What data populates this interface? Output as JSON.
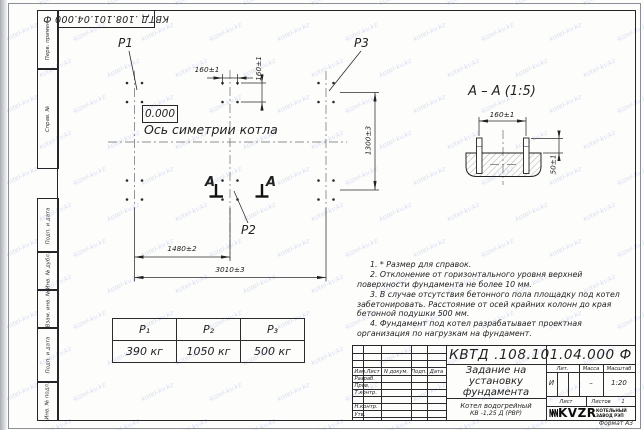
{
  "watermark": {
    "text": "kotel-kv.kz",
    "color": "#9fb0d8"
  },
  "top_stamp": {
    "number_inverted": "КВТД .108.101.04.000  Ф"
  },
  "margin_stamps": [
    "Перв. примен.",
    "Справ. №",
    "Подп. и дата",
    "Инв. № дубл.",
    "Взам. инв. №",
    "Подп. и дата",
    "Инв. № подл."
  ],
  "plan": {
    "elevation": "0.000",
    "axis_label": "Ось симетрии котла",
    "load_p1": "P1",
    "load_p2": "P2",
    "load_p3": "P3",
    "section_letter_left": "А",
    "section_letter_right": "А",
    "dim_bolt_horizontal": "160±1",
    "dim_bolt_vertical": "160±1",
    "dim_width": "1300±3",
    "dim_mid": "1480±2",
    "dim_total": "3010±3"
  },
  "section_view": {
    "title": "А  –  А (1:5)",
    "dim_bolt_spacing": "160±1",
    "dim_protrusion": "50±1"
  },
  "load_table": {
    "headers": [
      "P₁",
      "P₂",
      "P₃"
    ],
    "values": [
      "390 кг",
      "1050 кг",
      "500 кг"
    ]
  },
  "notes": [
    "1. * Размер для справок.",
    "2. Отклонение от горизонтального уровня верхней поверхности фундамента не более 10 мм.",
    "3. В случае отсутствия бетонного пола площадку под котел забетонировать. Расстояние от осей крайних колонн до края бетонной подушки 500 мм.",
    "4. Фундамент под котел разрабатывает проектная организация по нагрузкам на фундамент."
  ],
  "title_block": {
    "number": "КВТД .108.101.04.000  Ф",
    "title": "Задание на установку фундамента",
    "product_line1": "Котел водогрейный",
    "product_line2": "КВ -1,25 Д  (РВР)",
    "col_izm": "Изм.Лист",
    "col_doc": "N докум.",
    "col_sign": "Подп.",
    "col_date": "Дата",
    "row_developed": "Разраб.",
    "row_checked": "Пров.",
    "row_tcontrol": "Т.контр.",
    "row_ncontrol": "Н.контр.",
    "row_approved": "Утв.",
    "lit_label": "Лит.",
    "mass_label": "Масса",
    "scale_label": "Масштаб",
    "lit_value": "И",
    "mass_value": "–",
    "scale_value": "1:20",
    "sheet_label": "Лист",
    "sheets_label": "Листов",
    "sheets_value": "1",
    "logo_text": "KVZR",
    "logo_caption": "КОТЕЛЬНЫЙ ЗАВОД РЭП",
    "format": "Формат А3"
  }
}
